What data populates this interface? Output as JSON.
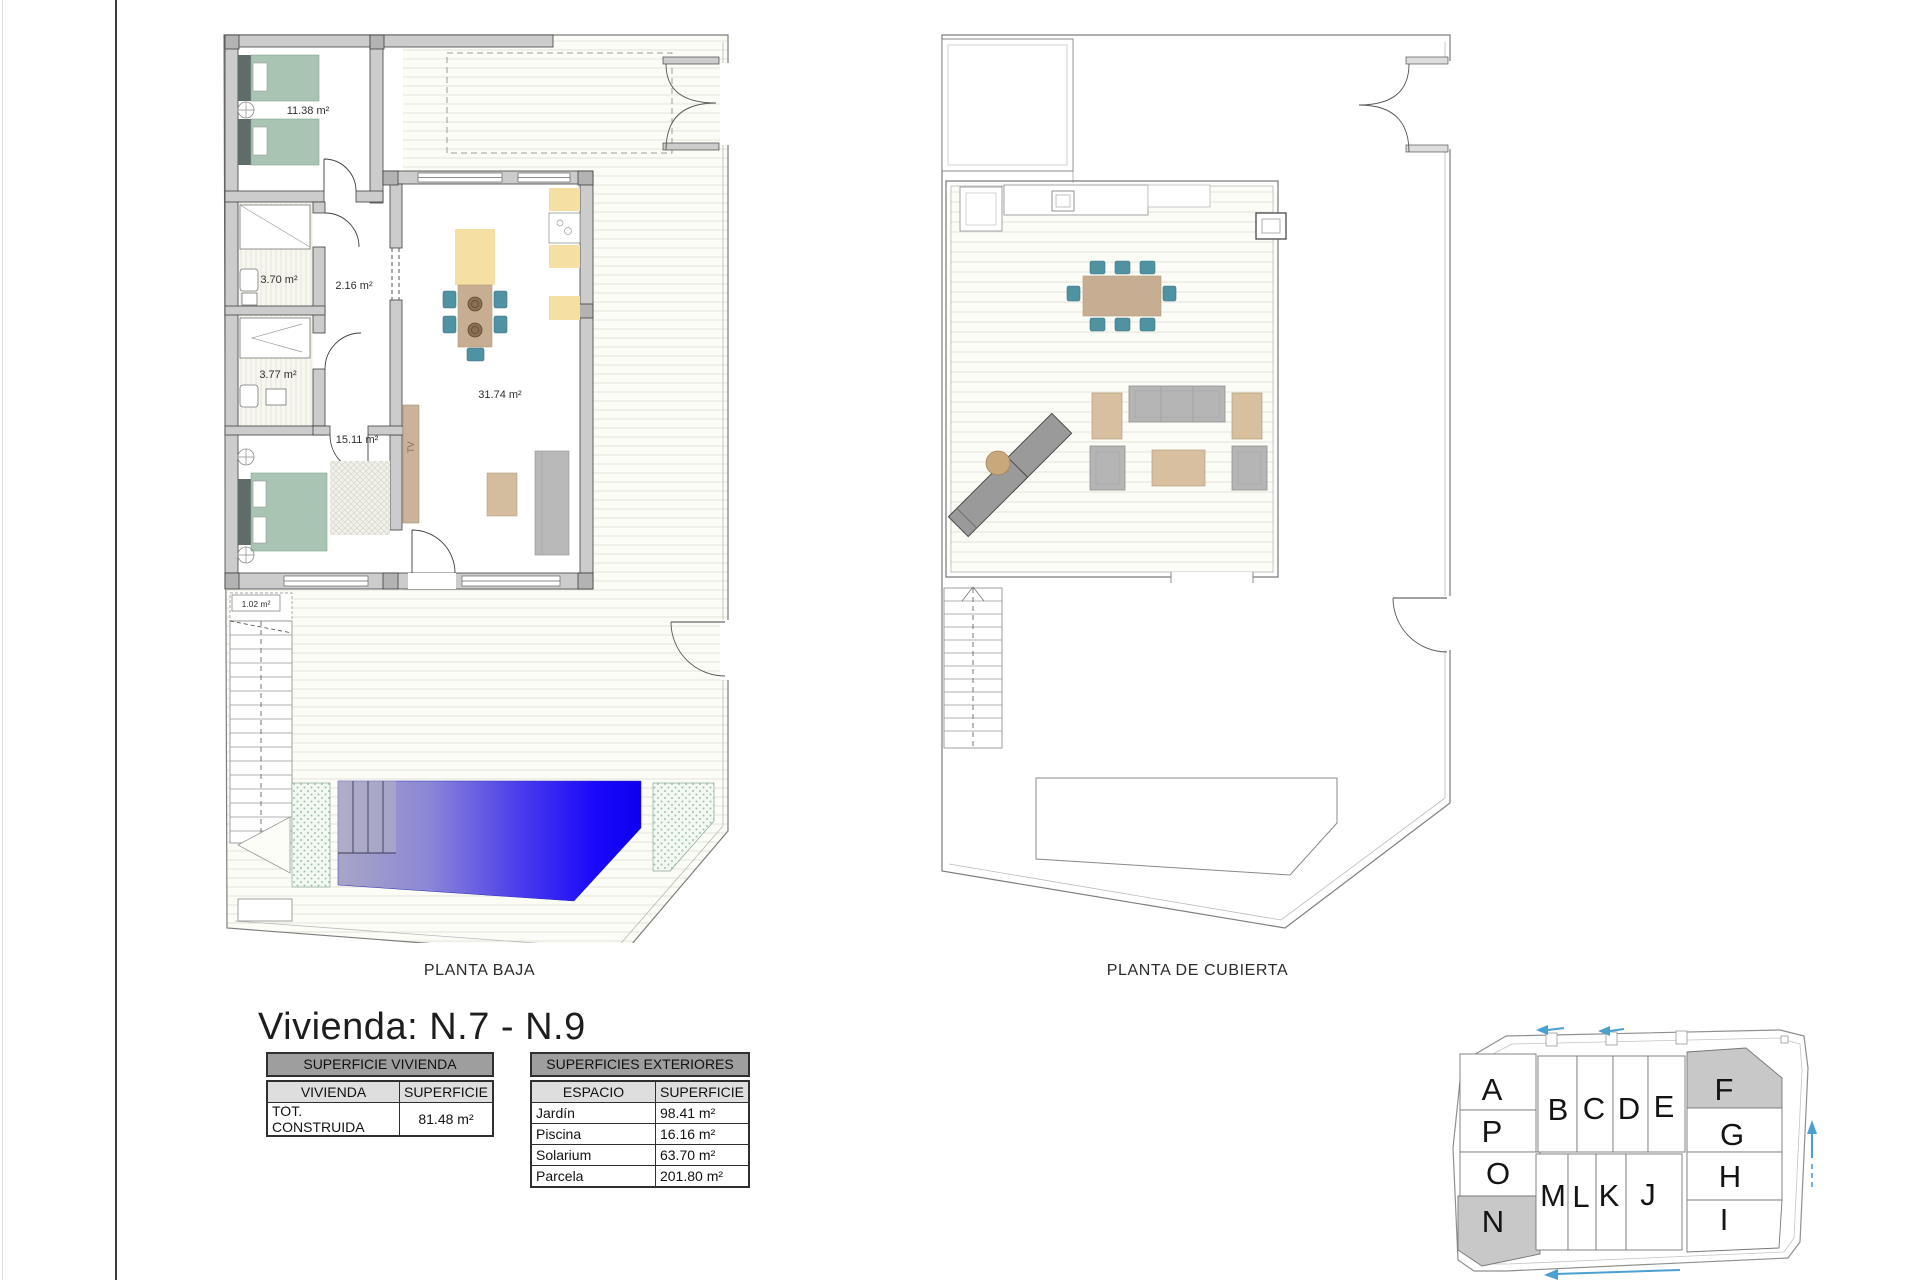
{
  "title": "Vivienda: N.7 - N.9",
  "captions": {
    "planta_baja": "PLANTA BAJA",
    "planta_cubierta": "PLANTA DE CUBIERTA"
  },
  "plans": {
    "planta_baja": {
      "labels": {
        "bedroom1": "11.38 m²",
        "bath1": "3.70 m²",
        "hall": "2.16 m²",
        "bath2": "3.77 m²",
        "bedroom2": "15.11 m²",
        "living": "31.74 m²",
        "stairs": "1.02 m²",
        "tv": "TV"
      }
    }
  },
  "tables": {
    "vivienda": {
      "title": "SUPERFICIE VIVIENDA",
      "col1": "VIVIENDA",
      "col2": "SUPERFICIE",
      "rows": [
        {
          "label": "TOT. CONSTRUIDA",
          "value": "81.48 m²"
        }
      ]
    },
    "exteriores": {
      "title": "SUPERFICIES EXTERIORES",
      "col1": "ESPACIO",
      "col2": "SUPERFICIE",
      "rows": [
        {
          "label": "Jardín",
          "value": "98.41 m²"
        },
        {
          "label": "Piscina",
          "value": "16.16 m²"
        },
        {
          "label": "Solarium",
          "value": "63.70 m²"
        },
        {
          "label": "Parcela",
          "value": "201.80 m²"
        }
      ]
    }
  },
  "sitemap": {
    "plots": [
      {
        "label": "A",
        "highlighted": false
      },
      {
        "label": "P",
        "highlighted": false
      },
      {
        "label": "O",
        "highlighted": false
      },
      {
        "label": "N",
        "highlighted": true
      },
      {
        "label": "B",
        "highlighted": false
      },
      {
        "label": "C",
        "highlighted": false
      },
      {
        "label": "D",
        "highlighted": false
      },
      {
        "label": "E",
        "highlighted": false
      },
      {
        "label": "M",
        "highlighted": false
      },
      {
        "label": "L",
        "highlighted": false
      },
      {
        "label": "K",
        "highlighted": false
      },
      {
        "label": "J",
        "highlighted": false
      },
      {
        "label": "F",
        "highlighted": true
      },
      {
        "label": "G",
        "highlighted": false
      },
      {
        "label": "H",
        "highlighted": false
      },
      {
        "label": "I",
        "highlighted": false
      }
    ]
  },
  "colors": {
    "pool_blue": "#0d00ef",
    "bed_sage": "#a9c4b3",
    "chair_teal": "#4f92a2",
    "counter_yellow": "#f5dfa3",
    "wood_tan": "#c7ae93",
    "wall_gray": "#cccccc",
    "plot_highlight": "#c8c8c8",
    "arrow_blue": "#4aa0d0"
  }
}
